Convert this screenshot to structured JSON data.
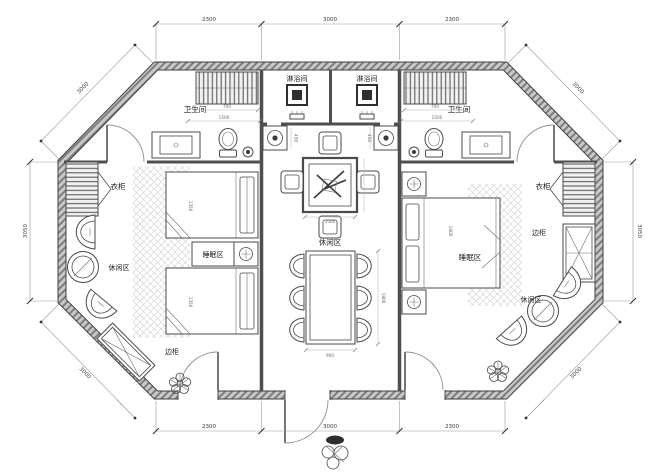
{
  "rooms": {
    "shower_room": "淋浴间",
    "bathroom": "卫生间",
    "wardrobe": "衣柜",
    "sleeping_area": "睡眠区",
    "leisure_area": "休闲区",
    "side_cabinet": "边柜"
  },
  "dimensions": {
    "top": [
      "2300",
      "3000",
      "2300"
    ],
    "bottom": [
      "2300",
      "3000",
      "2300"
    ],
    "left": "3050",
    "right": "3050",
    "diag_top_left": "3000",
    "diag_top_right": "3000",
    "diag_bottom_left": "3000",
    "diag_bottom_right": "3000",
    "closet_width": "700",
    "bathroom_width": "1500",
    "basin_width": "450",
    "twin_bed_length": "1350",
    "double_bed_length": "1800",
    "tea_table_size": "1000",
    "dining_table_width": "900",
    "dining_table_length": "1800"
  }
}
